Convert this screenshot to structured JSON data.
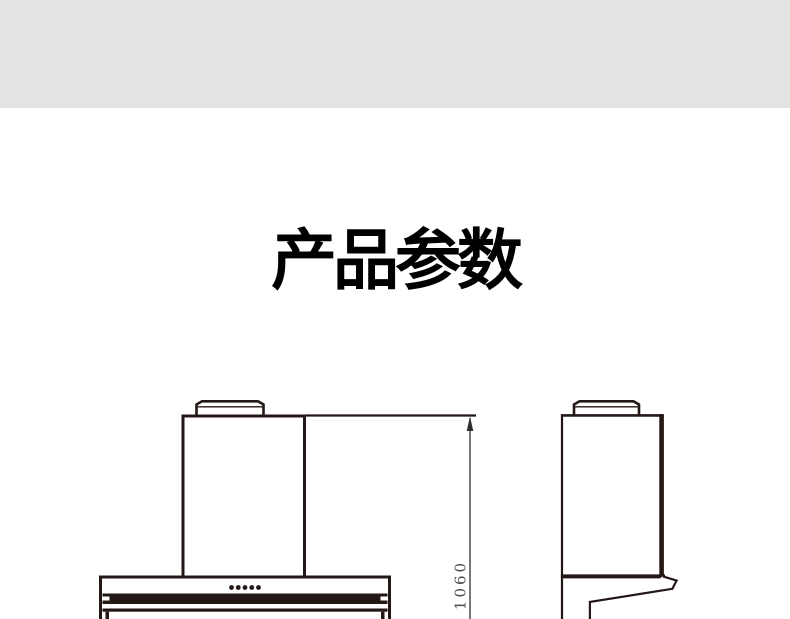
{
  "header": {
    "band_color": "#e3e3e3"
  },
  "section": {
    "title": "产品参数"
  },
  "diagram": {
    "subject": "range-hood technical dimension drawing",
    "line_color": "#231815",
    "dimension_line_color": "#2f2f2f",
    "height_mm": "1060",
    "control_dots_count": 5
  }
}
